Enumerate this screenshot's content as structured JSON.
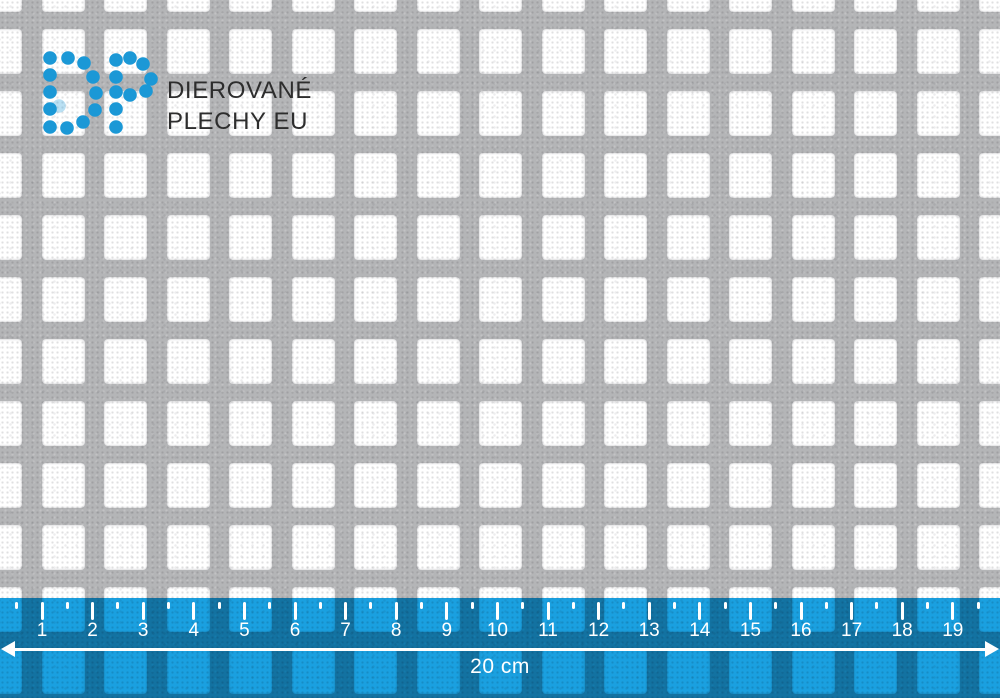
{
  "brand": {
    "line1": "DIEROVANÉ",
    "line2": "PLECHY EU",
    "dot_color": "#1b98d6",
    "text_color": "#2d2d2d",
    "dots_d": [
      [
        50,
        58
      ],
      [
        68,
        58
      ],
      [
        84,
        63
      ],
      [
        50,
        75
      ],
      [
        50,
        92
      ],
      [
        50,
        109
      ],
      [
        93,
        77
      ],
      [
        96,
        93
      ],
      [
        95,
        110
      ],
      [
        50,
        127
      ],
      [
        67,
        128
      ],
      [
        83,
        122
      ]
    ],
    "dots_p": [
      [
        116,
        60
      ],
      [
        130,
        58
      ],
      [
        143,
        64
      ],
      [
        116,
        77
      ],
      [
        116,
        92
      ],
      [
        116,
        109
      ],
      [
        116,
        127
      ],
      [
        151,
        79
      ],
      [
        146,
        91
      ],
      [
        130,
        95
      ]
    ],
    "dots_faded": [
      [
        59,
        106
      ]
    ],
    "dot_radius": 6.8
  },
  "sheet": {
    "description": "perforated metal sheet, square holes",
    "metal_color": "#b4b5b7",
    "hole_color": "#ffffff",
    "hole_width": 43,
    "hole_height": 45,
    "pitch_x": 62.5,
    "pitch_y": 62,
    "origin_x": -21,
    "origin_y": -33,
    "cols": 17,
    "rows": 12
  },
  "ruler": {
    "overlay_color": "#1aa0e0",
    "tick_color": "#ffffff",
    "top": 598,
    "height": 100,
    "first_tick_x": 42,
    "cm_px": 50.6,
    "numbers": [
      "1",
      "2",
      "3",
      "4",
      "5",
      "6",
      "7",
      "8",
      "9",
      "10",
      "11",
      "12",
      "13",
      "14",
      "15",
      "16",
      "17",
      "18",
      "19"
    ],
    "label": "20 cm"
  }
}
